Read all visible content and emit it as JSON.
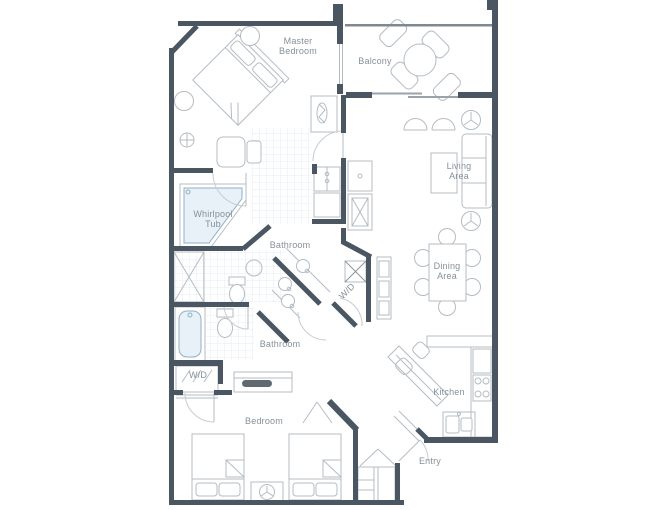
{
  "plan": {
    "type": "residential floor plan",
    "colors": {
      "wall": "#4a5661",
      "furniture_line": "#b4bcc3",
      "fixture_blue": "#8fb0c7",
      "fixture_fill": "#e8f1f7",
      "tile_line": "#e4edf3",
      "label_text": "#859099",
      "background": "#ffffff"
    },
    "rooms": {
      "master_bedroom": {
        "label": "Master Bedroom"
      },
      "balcony": {
        "label": "Balcony"
      },
      "living_area": {
        "label": "Living Area"
      },
      "whirlpool_tub": {
        "label": "Whirlpool Tub"
      },
      "master_bathroom": {
        "label": "Bathroom"
      },
      "dining_area": {
        "label": "Dining Area"
      },
      "guest_bathroom": {
        "label": "Bathroom"
      },
      "washer_dryer_center": {
        "label": "W/D"
      },
      "washer_dryer_left": {
        "label": "W/D"
      },
      "bedroom": {
        "label": "Bedroom"
      },
      "kitchen": {
        "label": "Kitchen"
      },
      "entry": {
        "label": "Entry"
      }
    }
  }
}
